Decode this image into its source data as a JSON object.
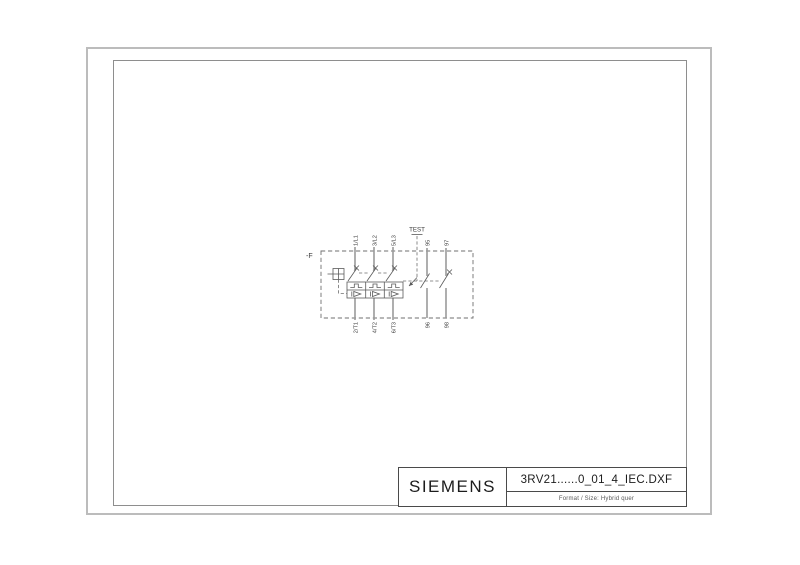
{
  "sheet": {
    "background_color": "#ffffff",
    "outer_frame_color": "#bcbcbc",
    "inner_frame_color": "#8e8e8e",
    "line_color": "#5a5a5a",
    "conductor_color": "#9b9b9b"
  },
  "title_block": {
    "brand": "SIEMENS",
    "filename": "3RV21......0_01_4_IEC.DXF",
    "format_line": "Format / Size: Hybrid quer"
  },
  "diagram": {
    "device_tag": "-F",
    "test_label": "TEST",
    "main_poles": {
      "top_terminals": [
        "1/L1",
        "3/L2",
        "5/L3"
      ],
      "bottom_terminals": [
        "2/T1",
        "4/T2",
        "6/T3"
      ]
    },
    "aux_contacts": {
      "top_terminals": [
        "95",
        "97"
      ],
      "bottom_terminals": [
        "96",
        "98"
      ]
    }
  }
}
